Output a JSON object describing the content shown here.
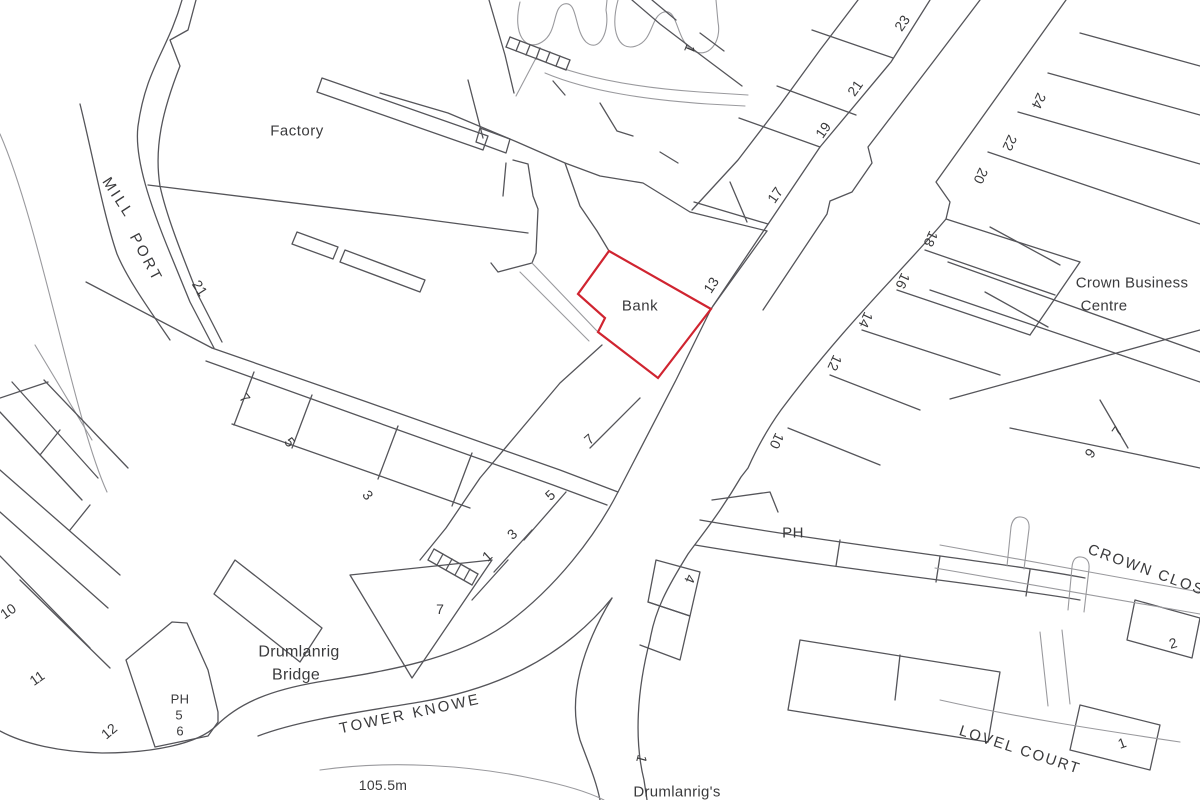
{
  "map": {
    "type": "cadastral-street-plan",
    "colors": {
      "background": "#ffffff",
      "line": "#55555a",
      "light_line": "#9a9a9e",
      "highlight": "#d02430",
      "text": "#3a3a3c"
    },
    "highlighted_property": {
      "label": "Bank",
      "outline_points": "609,251 711,309 658,378 598,332 605,318 578,294"
    },
    "labels": [
      {
        "name": "label-factory",
        "text": "Factory",
        "x": 297,
        "y": 131,
        "rot": 0,
        "size": 15,
        "spacing": 0.5
      },
      {
        "name": "label-mill",
        "text": "MILL",
        "x": 118,
        "y": 198,
        "rot": 57,
        "size": 15,
        "spacing": 3
      },
      {
        "name": "label-port",
        "text": "PORT",
        "x": 146,
        "y": 258,
        "rot": 62,
        "size": 15,
        "spacing": 3
      },
      {
        "name": "label-bank",
        "text": "Bank",
        "x": 640,
        "y": 306,
        "rot": 0,
        "size": 15,
        "spacing": 0.5
      },
      {
        "name": "label-crown-business",
        "text": "Crown Business",
        "x": 1132,
        "y": 283,
        "rot": 0,
        "size": 15,
        "spacing": 0.3
      },
      {
        "name": "label-crown-business-2",
        "text": "Centre",
        "x": 1104,
        "y": 306,
        "rot": 0,
        "size": 15,
        "spacing": 0.3
      },
      {
        "name": "label-drumlanrig",
        "text": "Drumlanrig",
        "x": 299,
        "y": 652,
        "rot": 0,
        "size": 16,
        "spacing": 0.3
      },
      {
        "name": "label-bridge",
        "text": "Bridge",
        "x": 296,
        "y": 675,
        "rot": 0,
        "size": 16,
        "spacing": 0.3
      },
      {
        "name": "label-tower-knowe",
        "text": "TOWER KNOWE",
        "x": 410,
        "y": 714,
        "rot": -12,
        "size": 15,
        "spacing": 2.5
      },
      {
        "name": "label-spot-height",
        "text": "105.5m",
        "x": 383,
        "y": 785,
        "rot": 0,
        "size": 14,
        "spacing": 0.3
      },
      {
        "name": "label-drumlanrigs",
        "text": "Drumlanrig's",
        "x": 677,
        "y": 792,
        "rot": 0,
        "size": 15,
        "spacing": 0.3
      },
      {
        "name": "label-crown-close",
        "text": "CROWN CLOSE",
        "x": 1152,
        "y": 572,
        "rot": 20,
        "size": 15,
        "spacing": 2
      },
      {
        "name": "label-lovel-court",
        "text": "LOVEL COURT",
        "x": 1020,
        "y": 750,
        "rot": 18,
        "size": 15,
        "spacing": 2
      },
      {
        "name": "label-ph-east",
        "text": "PH",
        "x": 793,
        "y": 533,
        "rot": 0,
        "size": 15,
        "spacing": 0.5
      },
      {
        "name": "label-ph-west",
        "text": "PH",
        "x": 180,
        "y": 699,
        "rot": 0,
        "size": 13,
        "spacing": 0.3
      },
      {
        "name": "label-ph-west-5",
        "text": "5",
        "x": 179,
        "y": 715,
        "rot": 0,
        "size": 13,
        "spacing": 0
      },
      {
        "name": "label-ph-west-6",
        "text": "6",
        "x": 180,
        "y": 731,
        "rot": 0,
        "size": 13,
        "spacing": 0
      }
    ],
    "plot_numbers": [
      {
        "text": "21",
        "x": 200,
        "y": 288,
        "rot": 57
      },
      {
        "text": "7",
        "x": 245,
        "y": 398,
        "rot": 52
      },
      {
        "text": "5",
        "x": 290,
        "y": 442,
        "rot": 52
      },
      {
        "text": "3",
        "x": 368,
        "y": 495,
        "rot": 52
      },
      {
        "text": "1",
        "x": 487,
        "y": 556,
        "rot": -42
      },
      {
        "text": "3",
        "x": 512,
        "y": 534,
        "rot": -42
      },
      {
        "text": "5",
        "x": 550,
        "y": 495,
        "rot": -42
      },
      {
        "text": "7",
        "x": 589,
        "y": 439,
        "rot": -42
      },
      {
        "text": "7",
        "x": 440,
        "y": 609,
        "rot": 0
      },
      {
        "text": "13",
        "x": 711,
        "y": 285,
        "rot": -57
      },
      {
        "text": "17",
        "x": 775,
        "y": 195,
        "rot": -55
      },
      {
        "text": "19",
        "x": 823,
        "y": 130,
        "rot": -55
      },
      {
        "text": "21",
        "x": 855,
        "y": 88,
        "rot": -55
      },
      {
        "text": "23",
        "x": 902,
        "y": 23,
        "rot": -55
      },
      {
        "text": "1",
        "x": 690,
        "y": 49,
        "rot": 112
      },
      {
        "text": "24",
        "x": 1039,
        "y": 101,
        "rot": 115
      },
      {
        "text": "22",
        "x": 1010,
        "y": 143,
        "rot": 115
      },
      {
        "text": "20",
        "x": 981,
        "y": 176,
        "rot": 115
      },
      {
        "text": "18",
        "x": 931,
        "y": 239,
        "rot": 115
      },
      {
        "text": "16",
        "x": 903,
        "y": 281,
        "rot": 115
      },
      {
        "text": "14",
        "x": 866,
        "y": 320,
        "rot": 115
      },
      {
        "text": "12",
        "x": 835,
        "y": 363,
        "rot": 115
      },
      {
        "text": "10",
        "x": 777,
        "y": 441,
        "rot": 115
      },
      {
        "text": "7",
        "x": 1117,
        "y": 431,
        "rot": -55
      },
      {
        "text": "9",
        "x": 1090,
        "y": 453,
        "rot": -55
      },
      {
        "text": "4",
        "x": 690,
        "y": 579,
        "rot": 112
      },
      {
        "text": "1",
        "x": 642,
        "y": 759,
        "rot": 105
      },
      {
        "text": "2",
        "x": 1173,
        "y": 643,
        "rot": -15
      },
      {
        "text": "1",
        "x": 1122,
        "y": 743,
        "rot": -20
      },
      {
        "text": "10",
        "x": 8,
        "y": 611,
        "rot": -35
      },
      {
        "text": "11",
        "x": 37,
        "y": 678,
        "rot": -35
      },
      {
        "text": "12",
        "x": 109,
        "y": 731,
        "rot": -40
      }
    ]
  }
}
